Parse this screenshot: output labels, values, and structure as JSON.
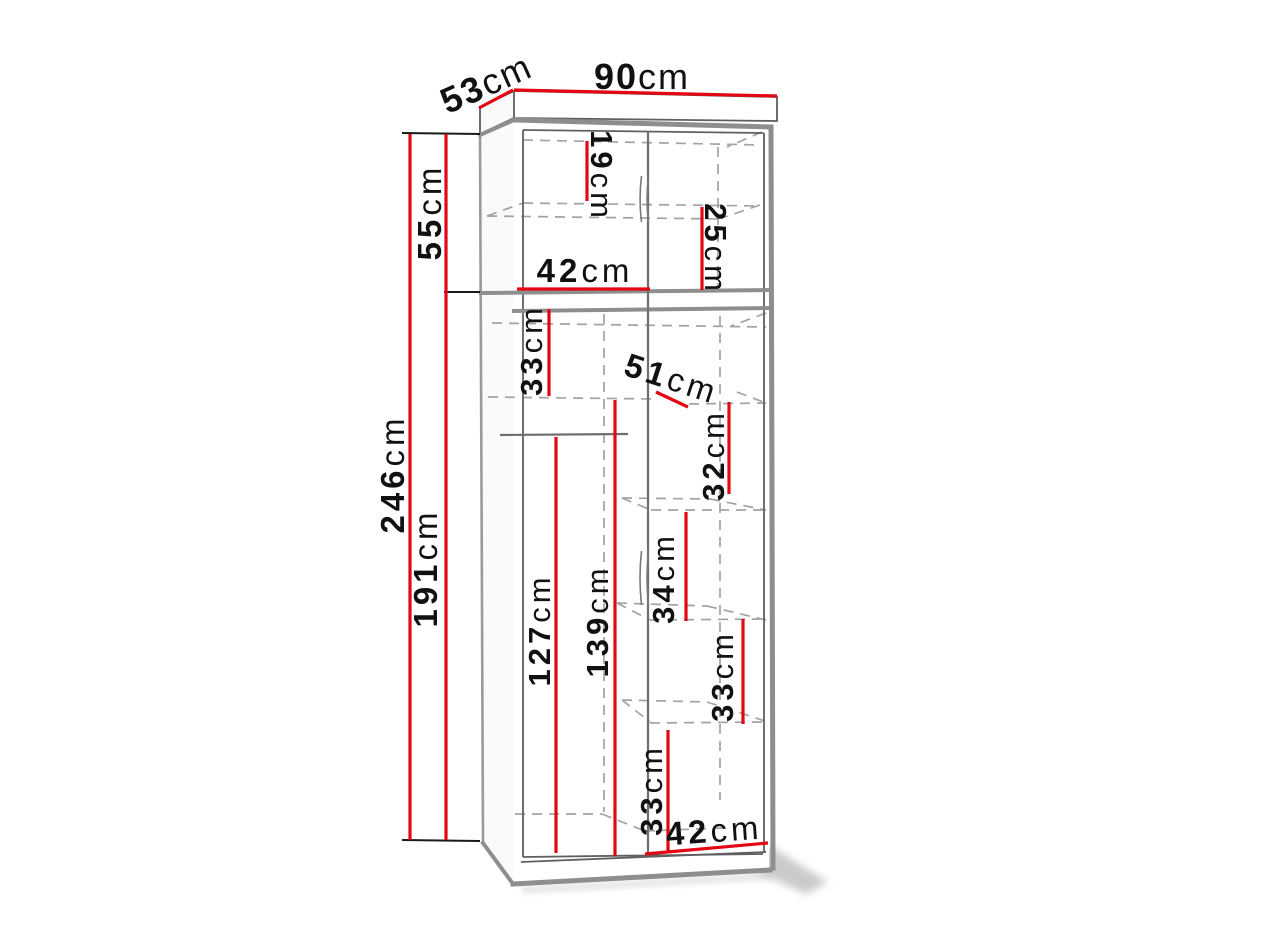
{
  "colors": {
    "dimension_red": "#e30613",
    "line_gray_thick": "#8e8e8e",
    "line_gray_dash": "#a3a3a3",
    "label_text": "#111111",
    "background": "#ffffff"
  },
  "dimensions": {
    "top_width": {
      "num": "90",
      "unit": "cm"
    },
    "top_depth": {
      "num": "53",
      "unit": "cm"
    },
    "upper_section_height": {
      "num": "55",
      "unit": "cm"
    },
    "total_height": {
      "num": "246",
      "unit": "cm"
    },
    "lower_section_height": {
      "num": "191",
      "unit": "cm"
    },
    "upper_left_height": {
      "num": "19",
      "unit": "cm"
    },
    "upper_right_height": {
      "num": "25",
      "unit": "cm"
    },
    "upper_shelf_width": {
      "num": "42",
      "unit": "cm"
    },
    "left_shelf_gap": {
      "num": "33",
      "unit": "cm"
    },
    "shelf_depth": {
      "num": "51",
      "unit": "cm"
    },
    "right_gap_1": {
      "num": "32",
      "unit": "cm"
    },
    "right_gap_2": {
      "num": "34",
      "unit": "cm"
    },
    "right_gap_3": {
      "num": "33",
      "unit": "cm"
    },
    "left_hanging_height": {
      "num": "127",
      "unit": "cm"
    },
    "center_hanging_height": {
      "num": "139",
      "unit": "cm"
    },
    "bottom_center_gap": {
      "num": "33",
      "unit": "cm"
    },
    "bottom_shelf_width": {
      "num": "42",
      "unit": "cm"
    }
  }
}
